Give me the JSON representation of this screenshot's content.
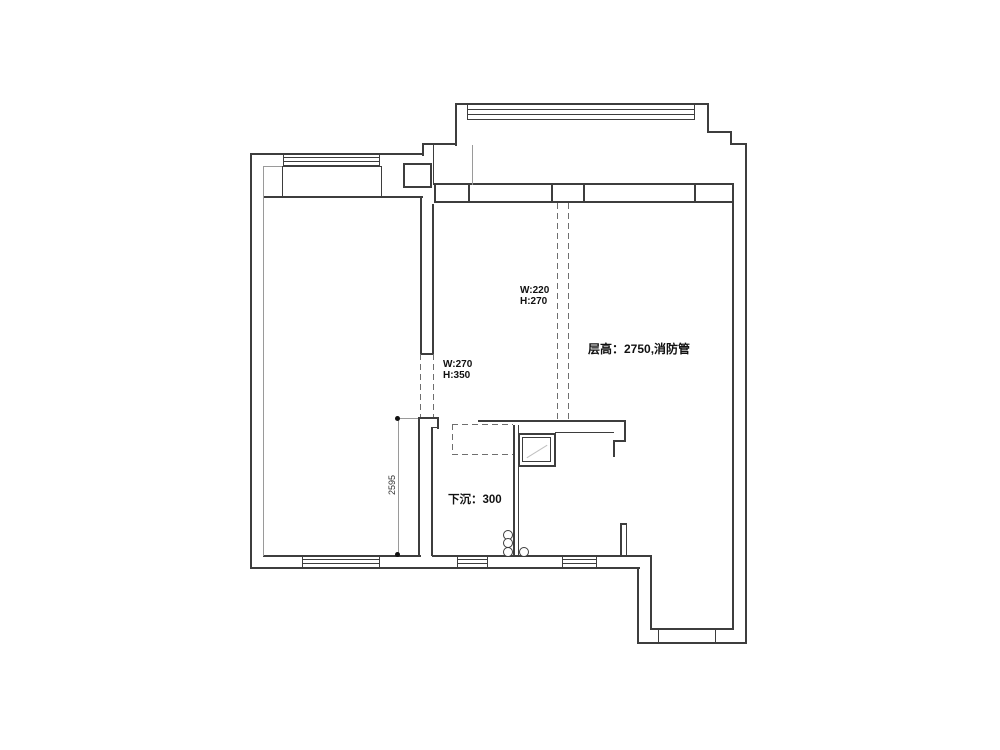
{
  "floor_plan": {
    "beam_top_label": {
      "line1": "W:220",
      "line2": "H:270"
    },
    "beam_side_label": {
      "line1": "W:270",
      "line2": "H:350"
    },
    "ceiling_height_note": "层高：2750,消防管",
    "sunken_floor_note": "下沉：300",
    "left_dimension": "2595"
  }
}
